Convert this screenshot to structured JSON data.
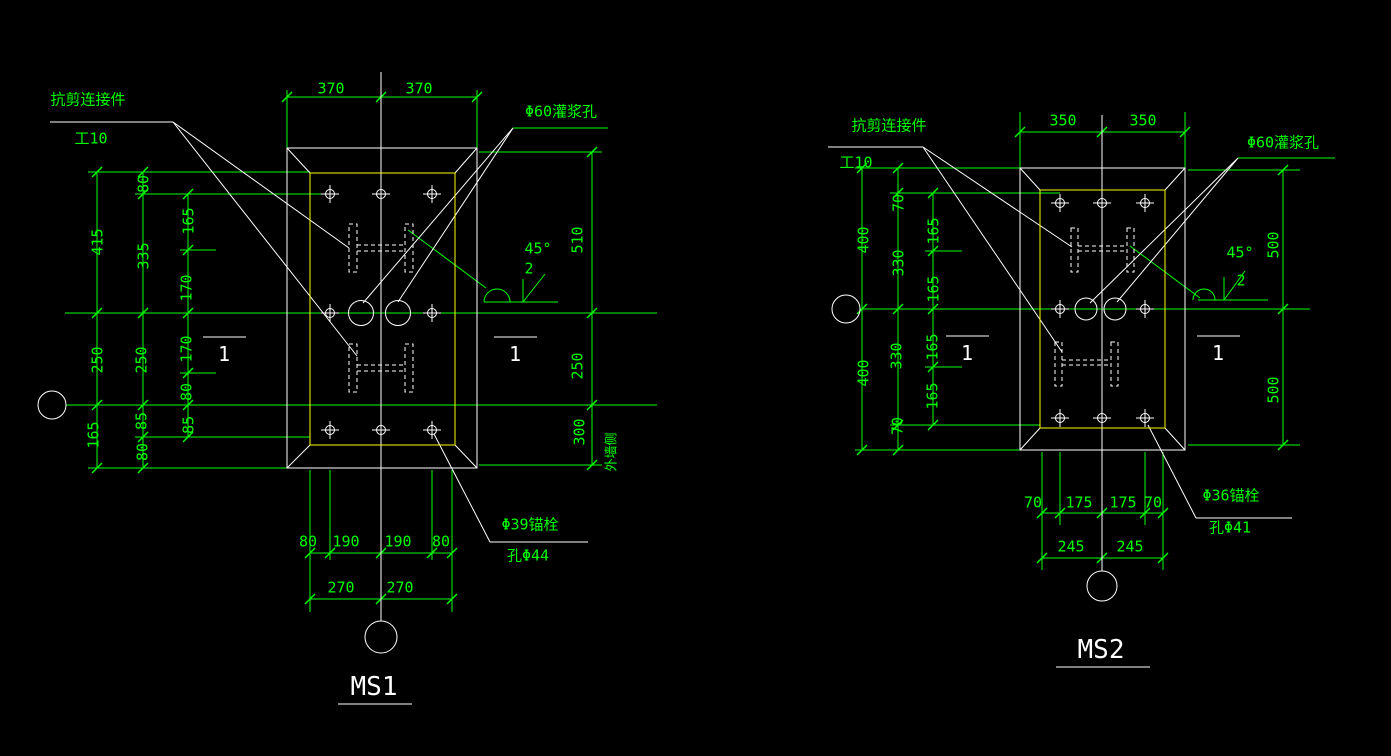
{
  "colors": {
    "background": "#000000",
    "dimension_lines": "#00ff00",
    "object_lines": "#ffffff",
    "plate_inner_outline": "#ffff00"
  },
  "left_view": {
    "title": "MS1",
    "labels": {
      "shear_connector": "抗剪连接件",
      "shear_connector_size": "工10",
      "grout_hole": "Φ60灌浆孔",
      "anchor_bolt": "Φ39锚栓",
      "anchor_bolt_hole": "孔Φ44",
      "bevel_angle": "45°",
      "bevel_size": "2",
      "section_mark_left": "1",
      "section_mark_right": "1",
      "wall_side": "外墙侧"
    },
    "dims": {
      "top": [
        "370",
        "370"
      ],
      "left_outer": [
        "415",
        "250",
        "165"
      ],
      "left_middle": [
        "80",
        "335",
        "250",
        "85",
        "80"
      ],
      "left_inner": [
        "165",
        "170",
        "170",
        "80",
        "85"
      ],
      "right": [
        "510",
        "250",
        "300"
      ],
      "bottom_row1": [
        "80",
        "190",
        "190",
        "80"
      ],
      "bottom_row2": [
        "270",
        "270"
      ]
    }
  },
  "right_view": {
    "title": "MS2",
    "labels": {
      "shear_connector": "抗剪连接件",
      "shear_connector_size": "工10",
      "grout_hole": "Φ60灌浆孔",
      "anchor_bolt": "Φ36锚栓",
      "anchor_bolt_hole": "孔Φ41",
      "bevel_angle": "45°",
      "bevel_size": "2",
      "section_mark_left": "1",
      "section_mark_right": "1"
    },
    "dims": {
      "top": [
        "350",
        "350"
      ],
      "left_outer": [
        "400",
        "400"
      ],
      "left_middle": [
        "70",
        "330",
        "330",
        "70"
      ],
      "left_inner": [
        "165",
        "165",
        "165",
        "165"
      ],
      "right": [
        "500",
        "500"
      ],
      "bottom_row1": [
        "70",
        "175",
        "175",
        "70"
      ],
      "bottom_row2": [
        "245",
        "245"
      ]
    }
  }
}
